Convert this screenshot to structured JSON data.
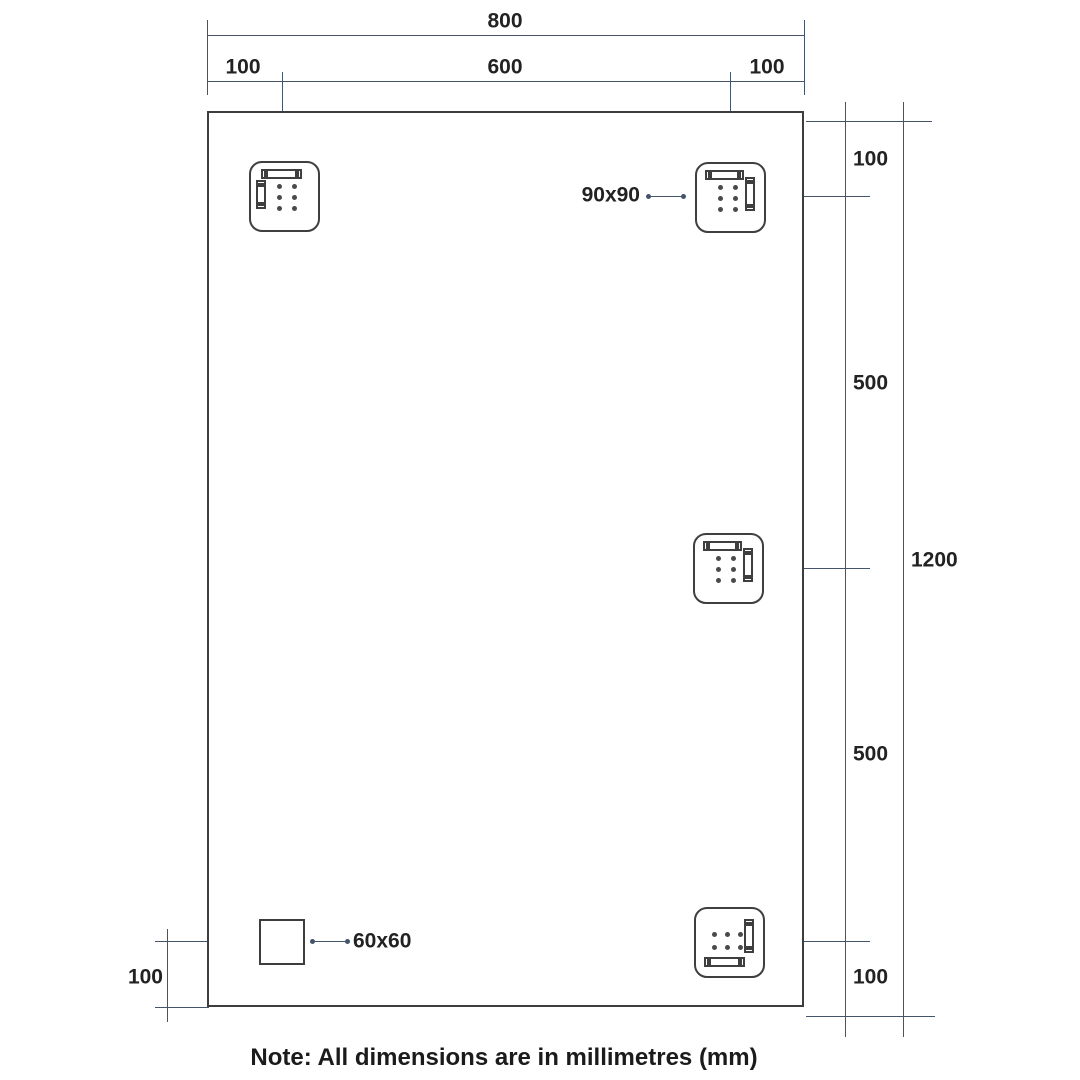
{
  "diagram": {
    "title": "Mirror mounting dimension drawing",
    "note": "Note: All dimensions are in millimetres (mm)",
    "colors": {
      "dimension_line": "#44546a",
      "object_outline": "#3f3f3f",
      "text": "#222222",
      "background": "#ffffff"
    },
    "dimensions": {
      "top_total": "800",
      "top_left": "100",
      "top_middle": "600",
      "top_right": "100",
      "right_top": "100",
      "right_upper": "500",
      "right_total": "1200",
      "right_lower": "500",
      "right_bottom": "100",
      "bottom_left": "100"
    },
    "labels": {
      "bracket_size": "90x90",
      "block_size": "60x60"
    }
  }
}
